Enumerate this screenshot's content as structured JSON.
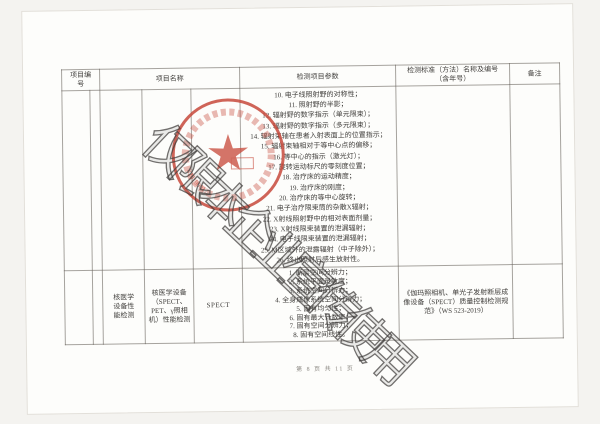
{
  "page": {
    "footer": "第 8 页 共 11 页"
  },
  "watermark": {
    "text": "仅限本企业宣传使用"
  },
  "stamp": {
    "serial": "420190012",
    "star": "★"
  },
  "colors": {
    "stamp_red": "#c84a3c",
    "watermark_gray": "#3e3c3a",
    "table_line_gray": "#8f8b84"
  },
  "table": {
    "headers": {
      "col_no": "项目编号",
      "col_name": "项目名称",
      "col_params": "检测项目参数",
      "col_standard_line1": "检测标准（方法）名称及编号",
      "col_standard_line2": "（含年号）",
      "col_remark": "备注"
    },
    "rows": [
      {
        "no": "",
        "category": "",
        "subcategory": "",
        "item": "",
        "params": [
          "10. 电子线照射野的对称性；",
          "11. 照射野的半影；",
          "12. 辐射野的数字指示（单元限束）；",
          "13. 辐射野的数字指示（多元限束）；",
          "14. 辐射束轴在患者入射表面上的位置指示；",
          "15. 辐射束轴相对于等中心点的偏移；",
          "16. 等中心的指示（激光灯）；",
          "17. 旋转运动标尺的零刻度位置；",
          "18. 治疗床的运动精度；",
          "19. 治疗床的刚度；",
          "20. 治疗床的等中心旋转；",
          "21. 电子治疗限束筒的杂散X辐射；",
          "22. X射线照射野中的相对表面剂量；",
          "23. X射线限束装置的泄漏辐射；",
          "24. 电子线限束装置的泄漏辐射；",
          "25. M区域外的泄露辐射（中子除外）；",
          "26. 终止照射后感生放射性。"
        ],
        "standard": "",
        "remark": ""
      },
      {
        "no": "",
        "category": "核医学设备性能检测",
        "subcategory": "核医学设备（SPECT、PET、γ照相机）性能检测",
        "item": "SPECT",
        "params": [
          "1. 断层空间分辨力；",
          "2. 系统平面灵敏度；",
          "3. 系统空间分辨力；",
          "4. 全身成像系统空间分辨力；",
          "5. 固有均匀性；",
          "6. 固有最大计数率；",
          "7. 固有空间分辨力；",
          "8. 固有空间线性。"
        ],
        "standard": "《伽玛照相机、单光子发射断层成像设备（SPECT）质量控制检测规范》（WS 523-2019）",
        "remark": ""
      }
    ]
  }
}
